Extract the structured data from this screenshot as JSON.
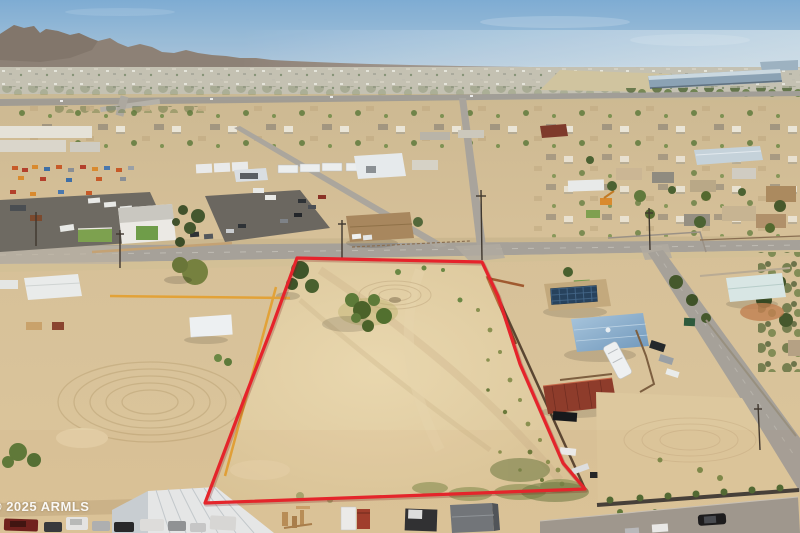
{
  "watermark": {
    "text": "© 2025 ARMLS"
  },
  "colors": {
    "boundary_red": "#e6232b",
    "boundary_yellow": "#e2a238",
    "sky_top": "#7cabd3",
    "sky_horizon": "#d8e3ea",
    "mountain": "#8c7d70",
    "road_asphalt": "#a6a199",
    "lot_center": "#e9d7ae",
    "lot_edge": "#d9c498",
    "solar_panel": "#27425d",
    "shed_red": "#8e3c2b",
    "roof_blue_light": "#8fb3d2",
    "roof_teal": "#d8e6e4",
    "warehouse_blue": "#8aa0b2"
  }
}
